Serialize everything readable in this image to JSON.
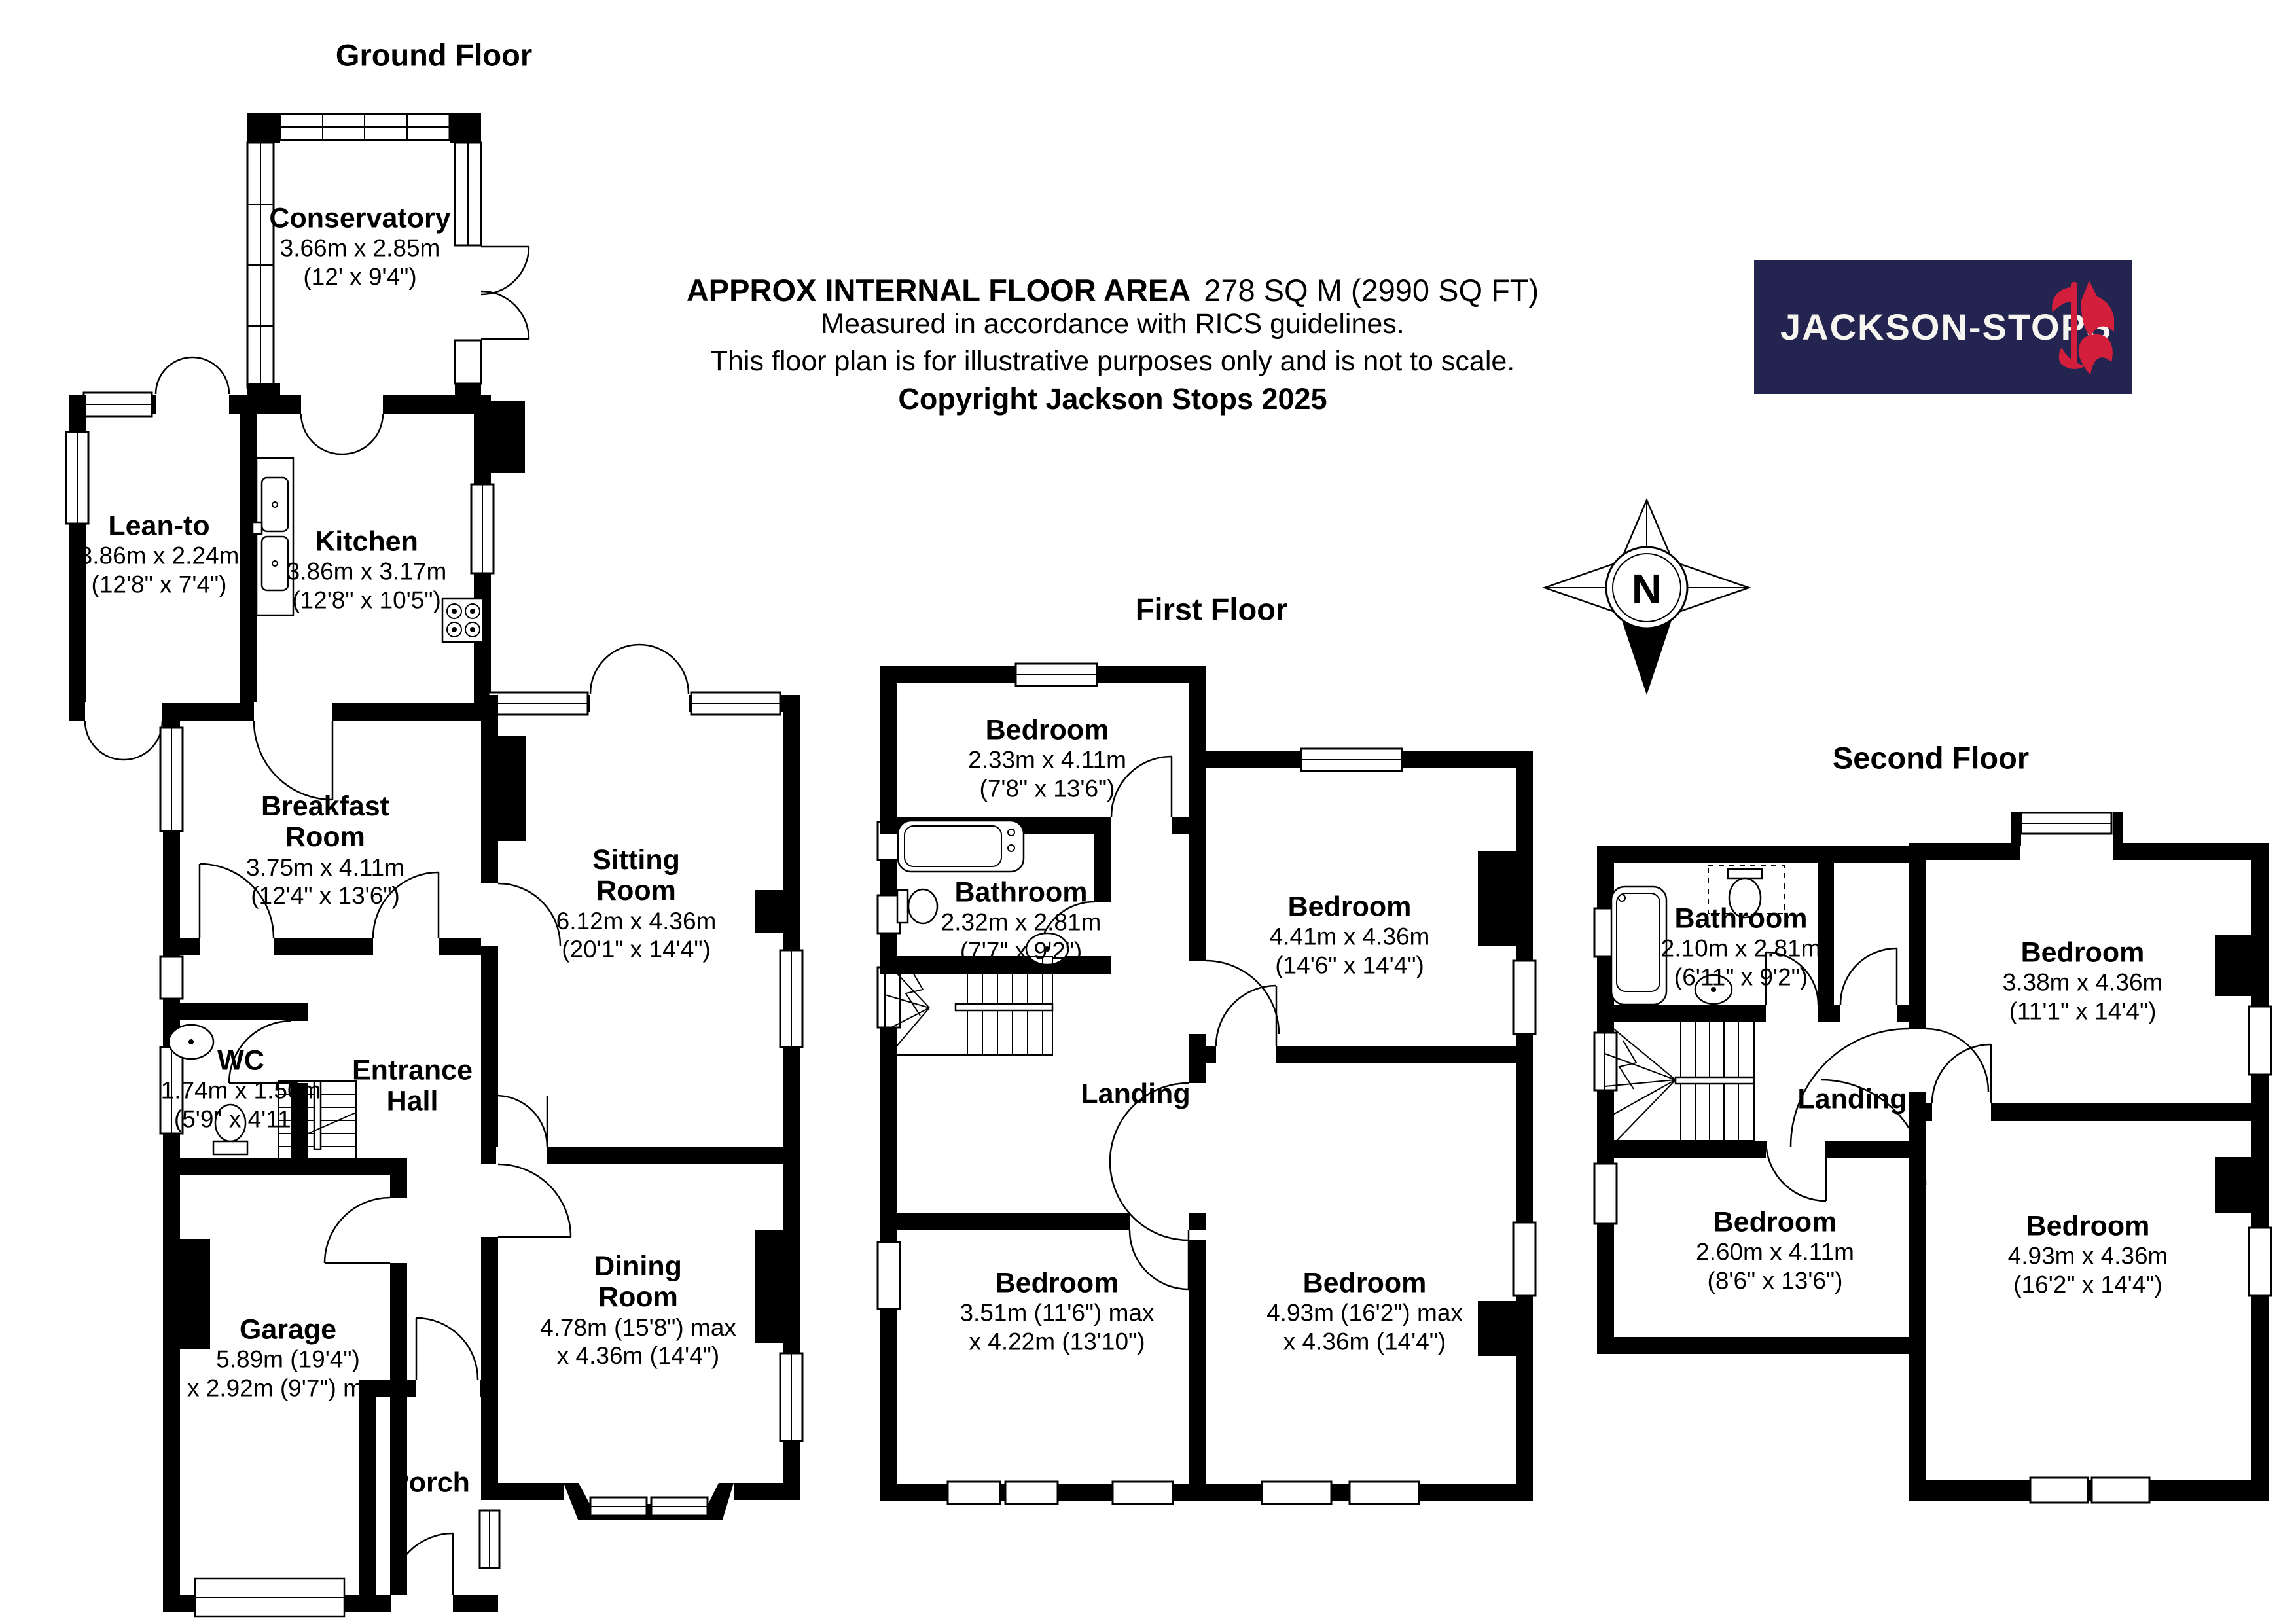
{
  "header": {
    "line1_bold": "APPROX INTERNAL FLOOR AREA",
    "line1_value": "278 SQ M (2990 SQ FT)",
    "line2": "Measured in accordance with RICS guidelines.",
    "line3": "This floor plan is for illustrative purposes only and is not to scale.",
    "line4": "Copyright Jackson Stops 2025"
  },
  "logo": {
    "text": "JACKSON-STOPS",
    "background_color": "#232450",
    "emblem_color": "#d41f3c",
    "emblem": "fox-with-axe-icon"
  },
  "compass": {
    "label": "N"
  },
  "floors": [
    {
      "title": "Ground Floor",
      "rooms": [
        {
          "name": "Conservatory",
          "dims_m": "3.66m x 2.85m",
          "dims_ft": "(12' x 9'4\")"
        },
        {
          "name": "Lean-to",
          "dims_m": "3.86m x 2.24m",
          "dims_ft": "(12'8\" x 7'4\")"
        },
        {
          "name": "Kitchen",
          "dims_m": "3.86m x 3.17m",
          "dims_ft": "(12'8\" x 10'5\")"
        },
        {
          "name": "Breakfast Room",
          "dims_m": "3.75m x 4.11m",
          "dims_ft": "(12'4\" x 13'6\")"
        },
        {
          "name": "Sitting Room",
          "dims_m": "6.12m x 4.36m",
          "dims_ft": "(20'1\" x 14'4\")"
        },
        {
          "name": "WC",
          "dims_m": "1.74m x 1.50m",
          "dims_ft": "(5'9\" x 4'11\")"
        },
        {
          "name": "Entrance Hall"
        },
        {
          "name": "Garage",
          "dims_m": "5.89m (19'4\")",
          "dims_ft": "x 2.92m (9'7\") max"
        },
        {
          "name": "Porch"
        },
        {
          "name": "Dining Room",
          "dims_m": "4.78m (15'8\") max",
          "dims_ft": "x 4.36m (14'4\")"
        }
      ]
    },
    {
      "title": "First Floor",
      "rooms": [
        {
          "name": "Bedroom",
          "dims_m": "2.33m x 4.11m",
          "dims_ft": "(7'8\" x 13'6\")"
        },
        {
          "name": "Bathroom",
          "dims_m": "2.32m x 2.81m",
          "dims_ft": "(7'7\" x 9'2\")"
        },
        {
          "name": "Bedroom",
          "dims_m": "4.41m x 4.36m",
          "dims_ft": "(14'6\" x 14'4\")"
        },
        {
          "name": "Landing"
        },
        {
          "name": "Bedroom",
          "dims_m": "3.51m (11'6\") max",
          "dims_ft": "x 4.22m (13'10\")"
        },
        {
          "name": "Bedroom",
          "dims_m": "4.93m (16'2\") max",
          "dims_ft": "x 4.36m (14'4\")"
        }
      ]
    },
    {
      "title": "Second Floor",
      "rooms": [
        {
          "name": "Bathroom",
          "dims_m": "2.10m x 2.81m",
          "dims_ft": "(6'11\" x 9'2\")"
        },
        {
          "name": "Bedroom",
          "dims_m": "3.38m x 4.36m",
          "dims_ft": "(11'1\" x 14'4\")"
        },
        {
          "name": "Landing"
        },
        {
          "name": "Bedroom",
          "dims_m": "2.60m x 4.11m",
          "dims_ft": "(8'6\" x 13'6\")"
        },
        {
          "name": "Bedroom",
          "dims_m": "4.93m x 4.36m",
          "dims_ft": "(16'2\" x 14'4\")"
        }
      ]
    }
  ]
}
